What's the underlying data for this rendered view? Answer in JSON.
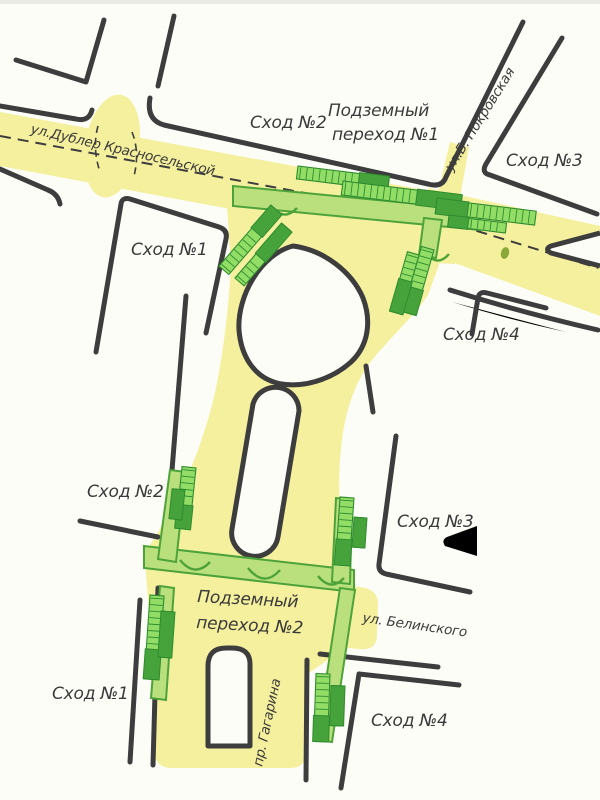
{
  "map": {
    "streets": {
      "dubler": "ул.Дублер  Красносельской",
      "pokrovskaya": "ул.Б.  Покровская",
      "belinskogo": "ул.  Белинского",
      "gagarina": "пр.  Гагарина"
    },
    "underpass1": {
      "name_line1": "Подземный",
      "name_line2": "переход №1",
      "exits": {
        "e1": "Сход №1",
        "e2": "Сход №2",
        "e3": "Сход №3",
        "e4": "Сход №4"
      }
    },
    "underpass2": {
      "name_line1": "Подземный",
      "name_line2": "переход №2",
      "exits": {
        "e1": "Сход №1",
        "e2": "Сход №2",
        "e3": "Сход №3",
        "e4": "Сход №4"
      }
    },
    "colors": {
      "paper": "#fdfdf8",
      "road": "#f5f09e",
      "line": "#3d3d3d",
      "corridor": "#b9e07c",
      "corridor_stroke": "#4da339",
      "stair_light": "#92dd66",
      "stair_dark": "#46a33c",
      "text": "#3a3a3a"
    }
  }
}
